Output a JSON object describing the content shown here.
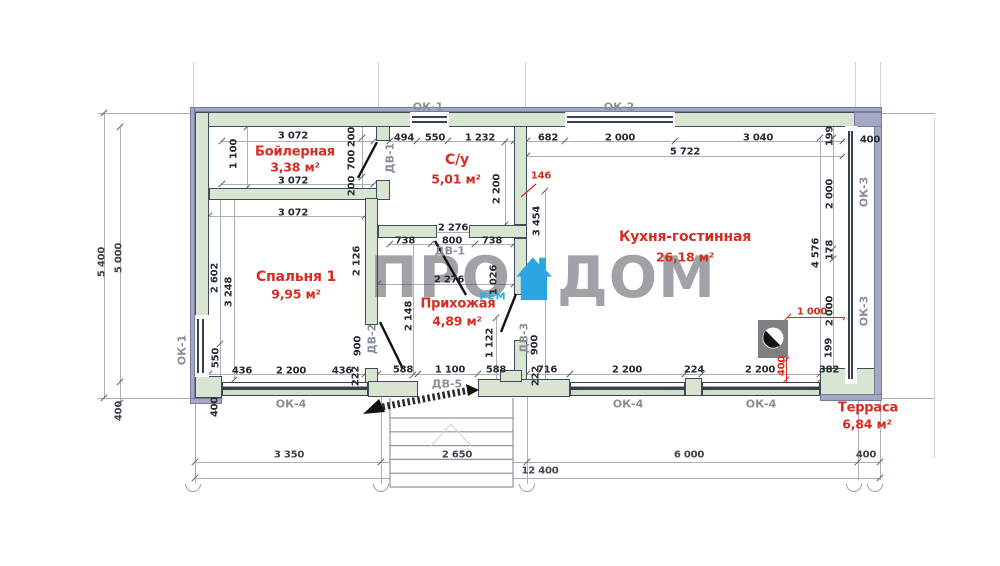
{
  "watermark": {
    "pro": "ПРО",
    "dom": "ДОМ",
    "rem": "РЕМ"
  },
  "rooms": [
    {
      "name": "Бойлерная",
      "area": "3,38 м²"
    },
    {
      "name": "С/у",
      "area": "5,01 м²"
    },
    {
      "name": "Спальня 1",
      "area": "9,95 м²"
    },
    {
      "name": "Прихожая",
      "area": "4,89 м²"
    },
    {
      "name": "Кухня-гостинная",
      "area": "26,18 м²"
    },
    {
      "name": "Терраса",
      "area": "6,84 м²"
    }
  ],
  "colors": {
    "wall_fill": "#d8e5d0",
    "wall_border": "#414b5e",
    "outer_band": "#a4a8c2",
    "accent_red": "#d92b20",
    "label_gray": "#8b9097",
    "dim_text": "#262a30",
    "logo_blue": "#2ba6e2"
  },
  "annotations": [
    {
      "t": "ОК-1",
      "x": 428,
      "y": 107,
      "cls": "tag"
    },
    {
      "t": "ОК-2",
      "x": 619,
      "y": 107,
      "cls": "tag"
    },
    {
      "t": "ОК-1",
      "x": 182,
      "y": 350,
      "cls": "tagv"
    },
    {
      "t": "ОК-3",
      "x": 864,
      "y": 192,
      "cls": "tagv"
    },
    {
      "t": "ОК-3",
      "x": 864,
      "y": 311,
      "cls": "tagv"
    },
    {
      "t": "ОК-4",
      "x": 291,
      "y": 404,
      "cls": "tag"
    },
    {
      "t": "ОК-4",
      "x": 628,
      "y": 404,
      "cls": "tag"
    },
    {
      "t": "ОК-4",
      "x": 761,
      "y": 404,
      "cls": "tag"
    },
    {
      "t": "ДВ-1",
      "x": 390,
      "y": 158,
      "cls": "tagv"
    },
    {
      "t": "ДВ-1",
      "x": 450,
      "y": 251,
      "cls": "tag"
    },
    {
      "t": "ДВ-2",
      "x": 372,
      "y": 339,
      "cls": "tagv"
    },
    {
      "t": "ДВ-3",
      "x": 524,
      "y": 338,
      "cls": "tagv"
    },
    {
      "t": "ДВ-5",
      "x": 447,
      "y": 384,
      "cls": "tag"
    },
    {
      "t": "Бойлерная",
      "x": 295,
      "y": 152,
      "cls": "red",
      "s": 13
    },
    {
      "t": "3,38 м²",
      "x": 295,
      "y": 167,
      "cls": "red",
      "s": 12.5
    },
    {
      "t": "С/у",
      "x": 457,
      "y": 160,
      "cls": "red",
      "s": 14
    },
    {
      "t": "5,01 м²",
      "x": 456,
      "y": 179,
      "cls": "red",
      "s": 12.5
    },
    {
      "t": "Спальня 1",
      "x": 296,
      "y": 277,
      "cls": "red",
      "s": 14
    },
    {
      "t": "9,95 м²",
      "x": 296,
      "y": 294,
      "cls": "red",
      "s": 12.5
    },
    {
      "t": "Прихожая",
      "x": 458,
      "y": 304,
      "cls": "red",
      "s": 13
    },
    {
      "t": "4,89 м²",
      "x": 457,
      "y": 321,
      "cls": "red",
      "s": 12.5
    },
    {
      "t": "Кухня-гостинная",
      "x": 685,
      "y": 237,
      "cls": "red",
      "s": 14
    },
    {
      "t": "26,18 м²",
      "x": 685,
      "y": 257,
      "cls": "red",
      "s": 12.5
    },
    {
      "t": "Терраса",
      "x": 868,
      "y": 408,
      "cls": "red",
      "s": 13
    },
    {
      "t": "6,84 м²",
      "x": 867,
      "y": 424,
      "cls": "red",
      "s": 12.5
    },
    {
      "t": "146",
      "x": 541,
      "y": 176,
      "cls": "red"
    },
    {
      "t": "1 000",
      "x": 812,
      "y": 312,
      "cls": "red"
    },
    {
      "t": "400",
      "x": 782,
      "y": 366,
      "cls": "redv"
    },
    {
      "t": "3 072",
      "x": 293,
      "y": 136,
      "cls": "dim"
    },
    {
      "t": "494",
      "x": 404,
      "y": 138,
      "cls": "dim"
    },
    {
      "t": "550",
      "x": 435,
      "y": 138,
      "cls": "dim"
    },
    {
      "t": "1 232",
      "x": 480,
      "y": 138,
      "cls": "dim"
    },
    {
      "t": "682",
      "x": 548,
      "y": 138,
      "cls": "dim"
    },
    {
      "t": "2 000",
      "x": 620,
      "y": 138,
      "cls": "dim"
    },
    {
      "t": "3 040",
      "x": 758,
      "y": 138,
      "cls": "dim"
    },
    {
      "t": "400",
      "x": 870,
      "y": 140,
      "cls": "dim"
    },
    {
      "t": "5 722",
      "x": 685,
      "y": 152,
      "cls": "dim"
    },
    {
      "t": "200",
      "x": 352,
      "y": 137,
      "cls": "dimv"
    },
    {
      "t": "700",
      "x": 352,
      "y": 160,
      "cls": "dimv"
    },
    {
      "t": "200",
      "x": 352,
      "y": 186,
      "cls": "dimv"
    },
    {
      "t": "199",
      "x": 830,
      "y": 136,
      "cls": "dimv"
    },
    {
      "t": "1 100",
      "x": 234,
      "y": 154,
      "cls": "dimv"
    },
    {
      "t": "3 072",
      "x": 293,
      "y": 181,
      "cls": "dim"
    },
    {
      "t": "3 072",
      "x": 293,
      "y": 213,
      "cls": "dim"
    },
    {
      "t": "2 200",
      "x": 497,
      "y": 189,
      "cls": "dimv"
    },
    {
      "t": "3 454",
      "x": 537,
      "y": 221,
      "cls": "dimv"
    },
    {
      "t": "2 000",
      "x": 830,
      "y": 194,
      "cls": "dimv"
    },
    {
      "t": "4 576",
      "x": 816,
      "y": 253,
      "cls": "dimv"
    },
    {
      "t": "178",
      "x": 830,
      "y": 250,
      "cls": "dimv"
    },
    {
      "t": "2 000",
      "x": 830,
      "y": 311,
      "cls": "dimv"
    },
    {
      "t": "199",
      "x": 829,
      "y": 348,
      "cls": "dimv"
    },
    {
      "t": "2 276",
      "x": 453,
      "y": 228,
      "cls": "dim"
    },
    {
      "t": "738",
      "x": 405,
      "y": 241,
      "cls": "dim"
    },
    {
      "t": "800",
      "x": 452,
      "y": 241,
      "cls": "dim"
    },
    {
      "t": "738",
      "x": 492,
      "y": 241,
      "cls": "dim"
    },
    {
      "t": "2 602",
      "x": 215,
      "y": 278,
      "cls": "dimv"
    },
    {
      "t": "3 248",
      "x": 229,
      "y": 292,
      "cls": "dimv"
    },
    {
      "t": "2 126",
      "x": 357,
      "y": 261,
      "cls": "dimv"
    },
    {
      "t": "2 148",
      "x": 409,
      "y": 316,
      "cls": "dimv"
    },
    {
      "t": "2 276",
      "x": 449,
      "y": 280,
      "cls": "dim"
    },
    {
      "t": "1 026",
      "x": 494,
      "y": 280,
      "cls": "dimv"
    },
    {
      "t": "900",
      "x": 358,
      "y": 346,
      "cls": "dimv"
    },
    {
      "t": "900",
      "x": 535,
      "y": 345,
      "cls": "dimv"
    },
    {
      "t": "1 122",
      "x": 490,
      "y": 343,
      "cls": "dimv"
    },
    {
      "t": "550",
      "x": 216,
      "y": 358,
      "cls": "dimv"
    },
    {
      "t": "400",
      "x": 215,
      "y": 407,
      "cls": "dimv"
    },
    {
      "t": "436",
      "x": 242,
      "y": 371,
      "cls": "dim"
    },
    {
      "t": "2 200",
      "x": 291,
      "y": 371,
      "cls": "dim"
    },
    {
      "t": "436",
      "x": 342,
      "y": 371,
      "cls": "dim"
    },
    {
      "t": "222",
      "x": 356,
      "y": 376,
      "cls": "dimv"
    },
    {
      "t": "588",
      "x": 403,
      "y": 370,
      "cls": "dim"
    },
    {
      "t": "1 100",
      "x": 450,
      "y": 370,
      "cls": "dim"
    },
    {
      "t": "588",
      "x": 496,
      "y": 370,
      "cls": "dim"
    },
    {
      "t": "222",
      "x": 536,
      "y": 376,
      "cls": "dimv"
    },
    {
      "t": "716",
      "x": 547,
      "y": 370,
      "cls": "dim"
    },
    {
      "t": "2 200",
      "x": 627,
      "y": 370,
      "cls": "dim"
    },
    {
      "t": "224",
      "x": 694,
      "y": 370,
      "cls": "dim"
    },
    {
      "t": "2 200",
      "x": 760,
      "y": 370,
      "cls": "dim"
    },
    {
      "t": "382",
      "x": 829,
      "y": 370,
      "cls": "dim"
    },
    {
      "t": "5 400",
      "x": 102,
      "y": 262,
      "cls": "mdimv"
    },
    {
      "t": "5 000",
      "x": 119,
      "y": 258,
      "cls": "mdimv"
    },
    {
      "t": "400",
      "x": 119,
      "y": 411,
      "cls": "mdimv"
    },
    {
      "t": "3 350",
      "x": 289,
      "y": 455,
      "cls": "mdim"
    },
    {
      "t": "2 650",
      "x": 457,
      "y": 455,
      "cls": "mdim"
    },
    {
      "t": "6 000",
      "x": 689,
      "y": 455,
      "cls": "mdim"
    },
    {
      "t": "400",
      "x": 866,
      "y": 455,
      "cls": "mdim"
    },
    {
      "t": "12 400",
      "x": 540,
      "y": 471,
      "cls": "mdim"
    }
  ]
}
